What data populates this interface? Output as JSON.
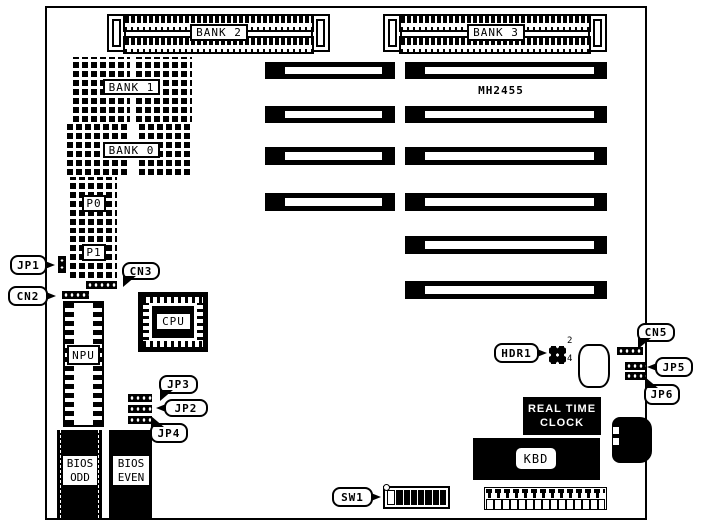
{
  "diagram": {
    "colors": {
      "ink": "#000000",
      "paper": "#ffffff"
    },
    "memory": {
      "bank2": "BANK 2",
      "bank3": "BANK 3",
      "bank1": "BANK 1",
      "bank0": "BANK 0",
      "p0": "P0",
      "p1": "P1"
    },
    "chips": {
      "mh2455": "MH2455",
      "cpu": "CPU",
      "npu": "NPU",
      "bios_odd_line1": "BIOS",
      "bios_odd_line2": "ODD",
      "bios_even_line1": "BIOS",
      "bios_even_line2": "EVEN",
      "rtc_line1": "REAL TIME",
      "rtc_line2": "CLOCK",
      "kbd": "KBD"
    },
    "callouts": {
      "jp1": "JP1",
      "cn2": "CN2",
      "cn3": "CN3",
      "jp3": "JP3",
      "jp2": "JP2",
      "jp4": "JP4",
      "hdr1": "HDR1",
      "cn5": "CN5",
      "jp5": "JP5",
      "jp6": "JP6",
      "sw1": "SW1"
    },
    "pin_numbers": {
      "hdr1_top": "2",
      "hdr1_bottom": "4"
    },
    "sw1_switches": [
      0,
      1,
      1,
      1,
      1,
      1,
      1,
      1
    ]
  }
}
